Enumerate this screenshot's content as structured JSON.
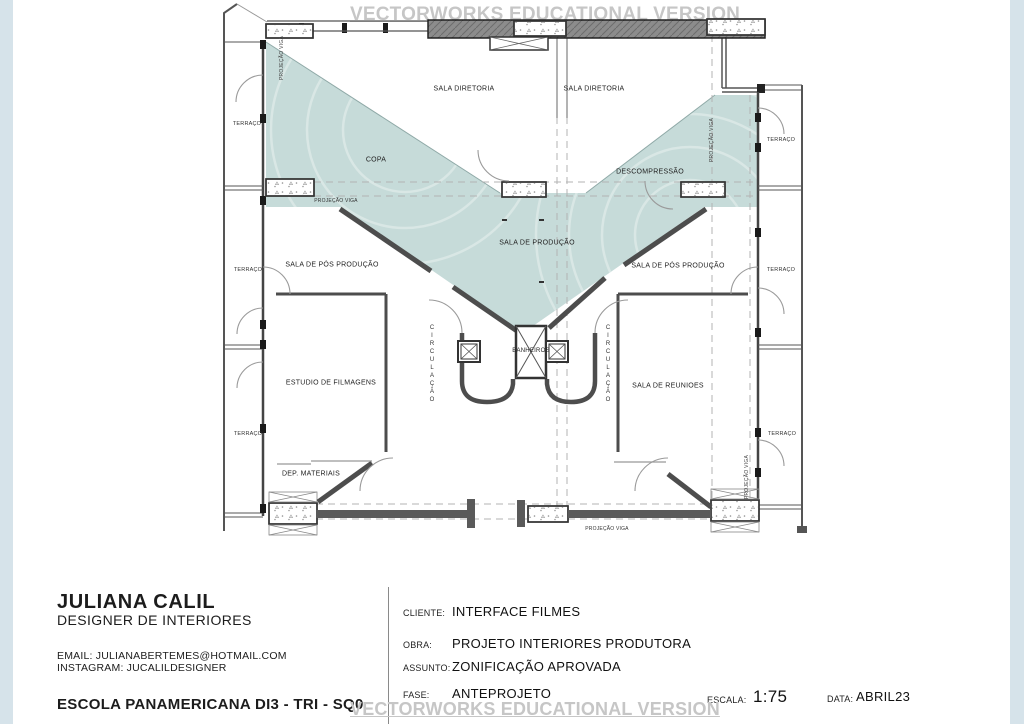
{
  "watermarks": {
    "top": "VECTORWORKS EDUCATIONAL VERSION",
    "bottom": "VECTORWORKS EDUCATIONAL VERSION"
  },
  "colors": {
    "zone_fill": "#c6dbd9",
    "edge_strip": "#d6e3ea",
    "wall": "#4d4d4d",
    "watermark_text": "#c6c6c6"
  },
  "plan": {
    "rooms": {
      "sala_diretoria_1": "SALA DIRETORIA",
      "sala_diretoria_2": "SALA DIRETORIA",
      "copa": "COPA",
      "descompressao": "DESCOMPRESSÃO",
      "sala_producao": "SALA DE PRODUÇÃO",
      "sala_pos_producao_1": "SALA DE PÓS PRODUÇÃO",
      "sala_pos_producao_2": "SALA DE PÓS PRODUÇÃO",
      "estudio_filmagens": "ESTUDIO DE FILMAGENS",
      "sala_reunioes": "SALA DE REUNIOES",
      "dep_materiais": "DEP. MATERIAIS",
      "banheiros": "BANHEIROS",
      "circulacao_1": "CIRCULAÇÃO",
      "circulacao_2": "CIRCULAÇÃO"
    },
    "terraces": {
      "t_l1": "TERRAÇO",
      "t_l2": "TERRAÇO",
      "t_l3": "TERRAÇO",
      "t_r1": "TERRAÇO",
      "t_r2": "TERRAÇO",
      "t_r3": "TERRAÇO"
    },
    "beams": {
      "v1": "PROJEÇÃO VIGA",
      "v2": "PROJEÇÃO VIGA",
      "v3": "PROJEÇÃO VIGA",
      "v4": "PROJEÇÃO VIGA",
      "v5": "PROJEÇÃO VIGA"
    }
  },
  "title_block": {
    "designer_name": "JULIANA CALIL",
    "designer_title": "DESIGNER DE INTERIORES",
    "email": "EMAIL: JULIANABERTEMES@HOTMAIL.COM",
    "instagram": "INSTAGRAM: JUCALILDESIGNER",
    "school": "ESCOLA PANAMERICANA DI3 - TRI - SQ0",
    "fields": {
      "cliente_label": "CLIENTE:",
      "cliente_value": "INTERFACE FILMES",
      "obra_label": "OBRA:",
      "obra_value": "PROJETO INTERIORES PRODUTORA",
      "assunto_label": "ASSUNTO:",
      "assunto_value": "ZONIFICAÇÃO APROVADA",
      "fase_label": "FASE:",
      "fase_value": "ANTEPROJETO",
      "escala_label": "ESCALA:",
      "escala_value": "1:75",
      "data_label": "DATA:",
      "data_value": "ABRIL23"
    }
  }
}
